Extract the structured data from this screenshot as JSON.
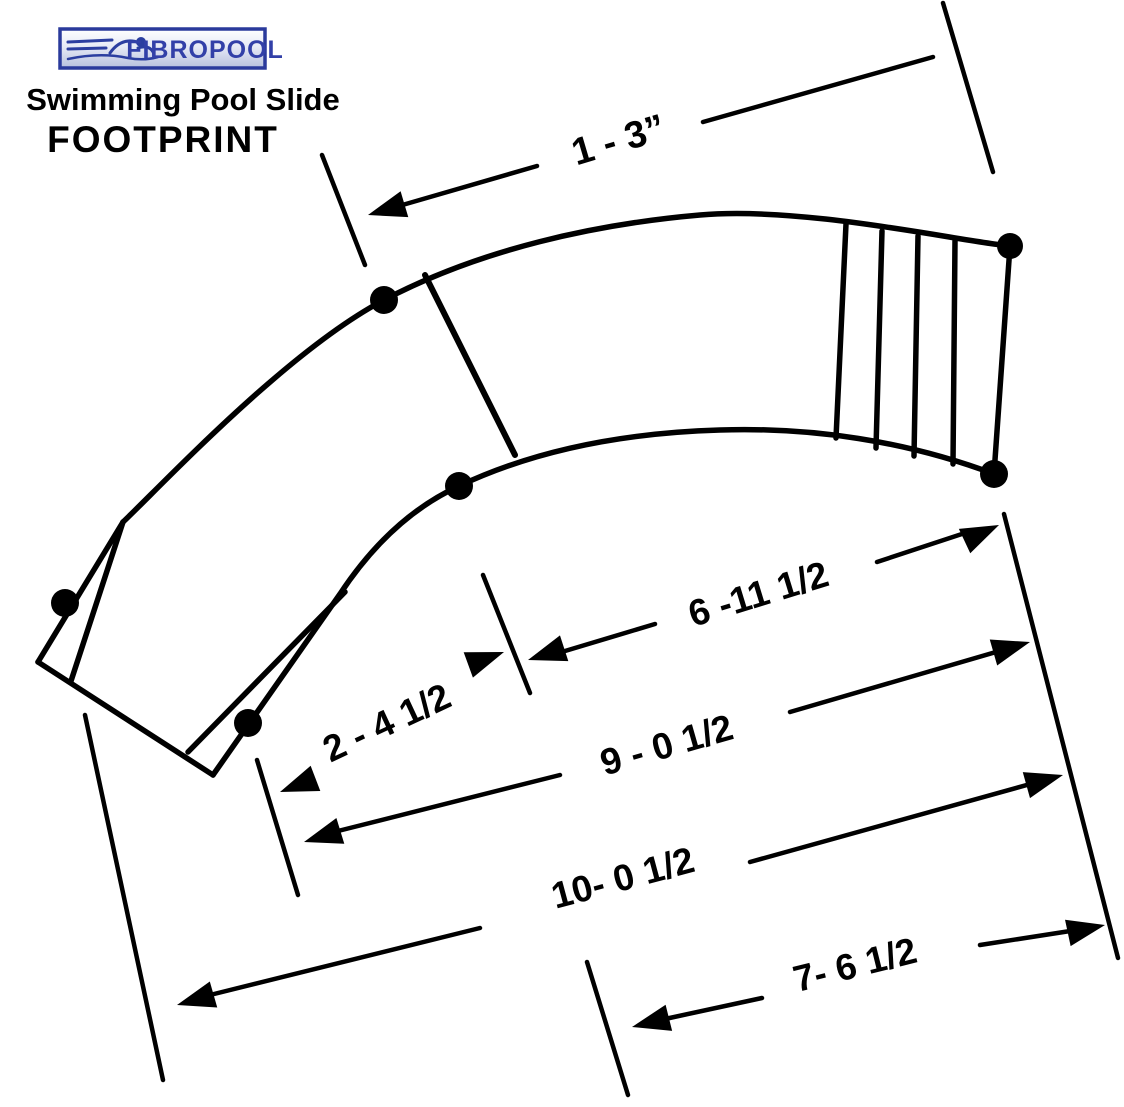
{
  "header": {
    "logo": {
      "text": "FIBROPOOL"
    },
    "title_line1": "Swimming Pool Slide",
    "title_line2": "FOOTPRINT"
  },
  "colors": {
    "ink": "#000000",
    "paper": "#ffffff",
    "logo_border_blue": "#2a3a9c",
    "logo_text_blue": "#3240a8"
  },
  "diagram": {
    "type": "dimensioned-footprint-drawing",
    "dims": {
      "top_width": {
        "label": "1 - 3”"
      },
      "upper_run": {
        "label": "6 -11 1/2"
      },
      "exit_width": {
        "label": "2 - 4 1/2"
      },
      "mid_run": {
        "label": "9 - 0 1/2"
      },
      "total_run": {
        "label": "10- 0 1/2"
      },
      "lower_run": {
        "label": "7- 6 1/2"
      }
    }
  }
}
